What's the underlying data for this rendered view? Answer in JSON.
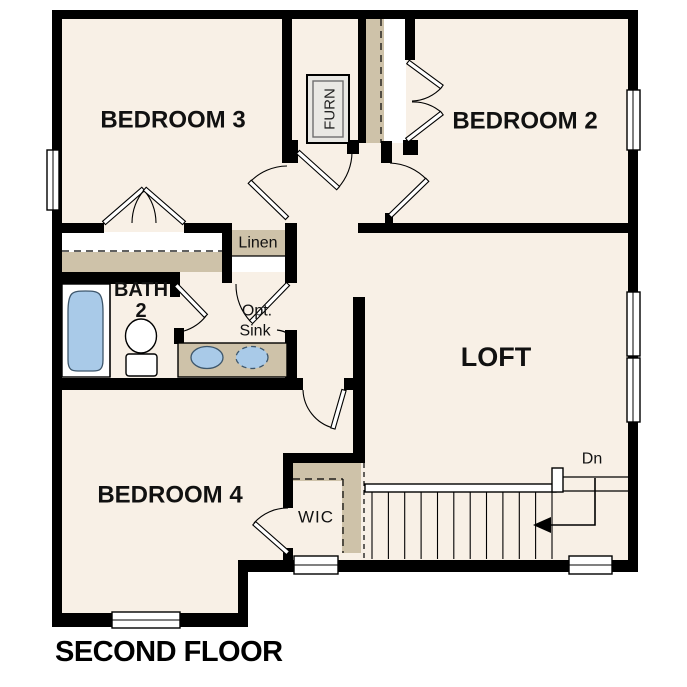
{
  "title": "SECOND FLOOR",
  "colors": {
    "floor": "#f8f0e6",
    "wall": "#000000",
    "casework": "#cec2a9",
    "fixture_blue": "#a9cae8",
    "furnace_gray": "#e9e8e4"
  },
  "labels": {
    "bedroom3": "BEDROOM 3",
    "bedroom2": "BEDROOM 2",
    "bedroom4": "BEDROOM 4",
    "loft": "LOFT",
    "bath_line1": "BATH",
    "bath_line2": "2",
    "wic": "WIC",
    "linen": "Linen",
    "furnace": "FURN",
    "opt_sink_line1": "Opt.",
    "opt_sink_line2": "Sink",
    "stairs_direction": "Dn"
  }
}
